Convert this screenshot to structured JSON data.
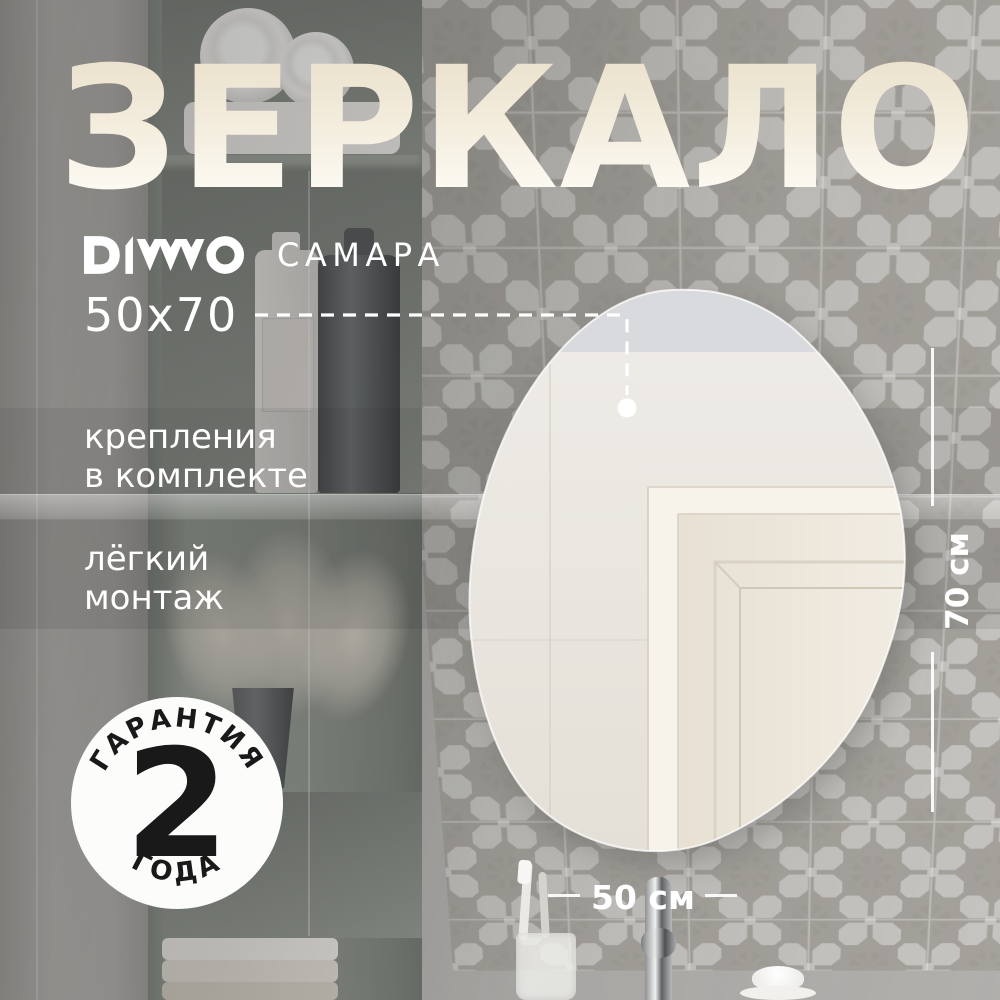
{
  "title": {
    "text": "ЗЕРКАЛО",
    "color_top": "#e9dfca",
    "color_bottom": "#fffef9"
  },
  "brand": {
    "name": "DIWO",
    "logo_icon": "diwo-chevrons-logo",
    "color": "#ffffff"
  },
  "product": {
    "model": "САМАРА",
    "size": "50x70"
  },
  "features": [
    {
      "lines": [
        "крепления",
        "в комплекте"
      ]
    },
    {
      "lines": [
        "лёгкий",
        "монтаж"
      ]
    }
  ],
  "warranty": {
    "arc_top": "ГАРАНТИЯ",
    "value": "2",
    "arc_bottom": "ГОДА",
    "bg_color": "#fcfcfb",
    "text_color": "#191919"
  },
  "dimensions": {
    "width_label": "50 см",
    "height_label": "70 см",
    "color": "#ffffff"
  },
  "scene": {
    "tile_bg_color": "#c8c6c2",
    "tile_star_color": "#a6a39d",
    "mirror_shape": "organic-blob-mirror",
    "props": [
      "rolled-towels",
      "cosmetic-bottles",
      "pampas-plant",
      "folded-towels",
      "toothbrush-cup",
      "chrome-faucet",
      "white-bowl"
    ]
  }
}
